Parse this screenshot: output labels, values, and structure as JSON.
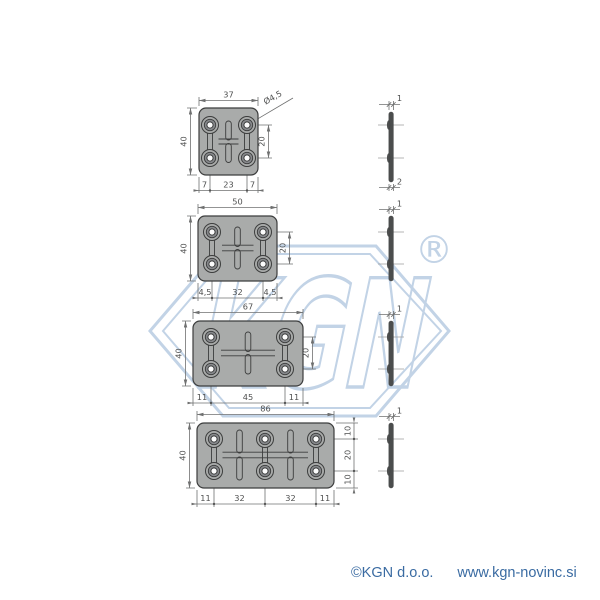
{
  "watermark": {
    "brand": "KGN",
    "registered_mark": "®"
  },
  "footer": {
    "copyright": "©KGN d.o.o.",
    "website": "www.kgn-novinc.si"
  },
  "colors": {
    "plate_fill": "#a9abaa",
    "outline": "#3c3d3d",
    "dimension_line": "#6f7070",
    "dimension_text": "#4f5050",
    "watermark_blue": "#c2d3e6",
    "footer_blue": "#3a6ba2"
  },
  "drawings": [
    {
      "name": "connecting plate 37x40",
      "top_width": "37",
      "left_height": "40",
      "hole_diameter": "Ø4,5",
      "hole_spacing_v": "20",
      "bottom_dims": [
        "7",
        "23",
        "7"
      ],
      "side_view": {
        "thickness": "1",
        "base_thickness": "2"
      }
    },
    {
      "name": "connecting plate 50x40",
      "top_width": "50",
      "left_height": "40",
      "hole_spacing_v": "20",
      "bottom_dims": [
        "4,5",
        "32",
        "4,5"
      ],
      "side_view": {
        "thickness": "1"
      }
    },
    {
      "name": "connecting plate 67x40",
      "top_width": "67",
      "left_height": "40",
      "hole_spacing_v": "20",
      "bottom_dims": [
        "11",
        "45",
        "11"
      ],
      "side_view": {
        "thickness": "1"
      }
    },
    {
      "name": "connecting plate 86x40",
      "top_width": "86",
      "left_height": "40",
      "hole_spacing_v": "20",
      "right_dims": [
        "10",
        "20",
        "10"
      ],
      "bottom_dims": [
        "11",
        "32",
        "32",
        "11"
      ],
      "side_view": {
        "thickness": "1"
      }
    }
  ]
}
